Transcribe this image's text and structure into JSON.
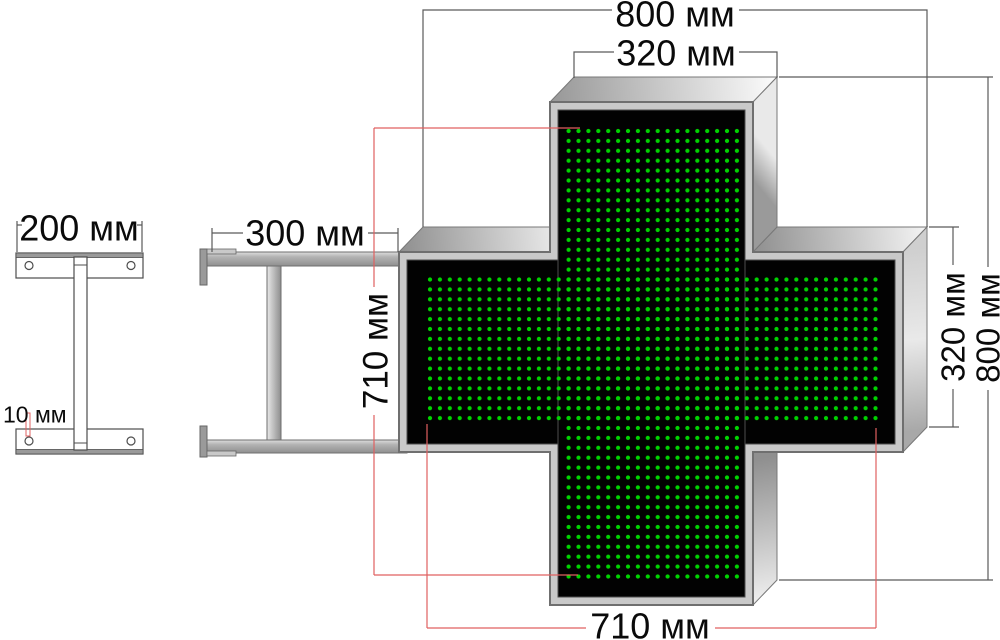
{
  "diagram": {
    "kind": "technical drawing of LED pharmacy cross sign with wall mount bracket"
  },
  "dimensions": {
    "bracket_plate_width": "200 мм",
    "bracket_hole_diameter": "10 мм",
    "mount_arm_length": "300 мм",
    "cross_overall_width": "800 мм",
    "cross_arm_width": "320 мм",
    "led_matrix_height": "710 мм",
    "cross_arm_height": "320 мм",
    "cross_overall_height": "800 мм",
    "led_matrix_width": "710 мм"
  },
  "colors": {
    "led_green": "#00d400",
    "panel_black": "#020202",
    "dimension_red": "#e06060",
    "dimension_gray": "#5a5a5a",
    "cabinet_frame": "#c9c9c9"
  }
}
